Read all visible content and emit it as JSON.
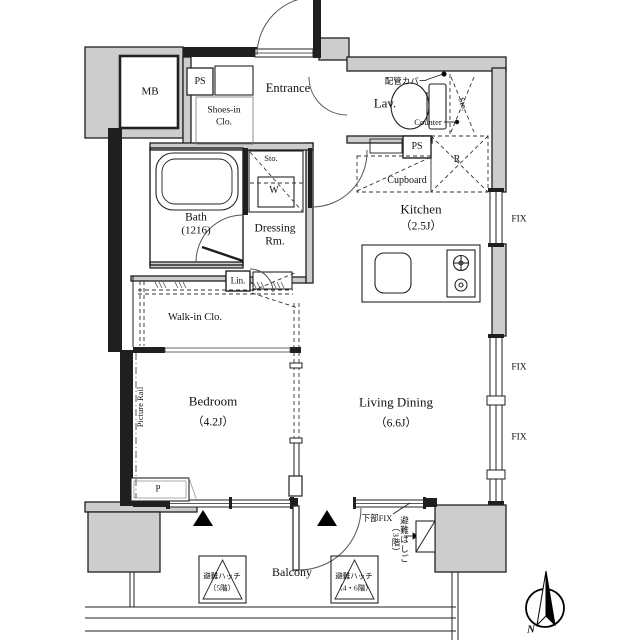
{
  "rooms": {
    "entrance": "Entrance",
    "shoes_line1": "Shoes-in",
    "shoes_line2": "Clo.",
    "lav": "Lav.",
    "kitchen_name": "Kitchen",
    "kitchen_size": "（2.5J）",
    "bath_name": "Bath",
    "bath_size": "(1216)",
    "dressing_line1": "Dressing",
    "dressing_line2": "Rm.",
    "walkin": "Walk-in Clo.",
    "bedroom_name": "Bedroom",
    "bedroom_size": "（4.2J）",
    "living_name": "Living Dining",
    "living_size": "（6.6J）",
    "balcony": "Balcony"
  },
  "labels": {
    "mb": "MB",
    "ps_entrance": "PS",
    "ps_kitchen": "PS",
    "pipe_cover": "配管カバー",
    "sto_lavatory": "Sto.",
    "counter": "Counter",
    "cupboard": "Cupboard",
    "refrigerator": "R",
    "sto_dressing": "Sto.",
    "washer": "W",
    "linen": "Lin.",
    "picture_rail": "Picture Rail",
    "pipe_duct": "P",
    "fix_top": "FIX",
    "fix_middle": "FIX",
    "fix_bottom": "FIX",
    "lower_fix": "下部FIX",
    "hatch_5f_line1": "避難ハッチ",
    "hatch_5f_line2": "（5階）",
    "hatch_46f_line1": "避難ハッチ",
    "hatch_46f_line2": "（4・6階）",
    "ladder_line1": "避難はしご",
    "ladder_line2": "（3階）",
    "north": "N"
  },
  "colors": {
    "wall_black": "#1f1f1f",
    "wall_gray": "#cdcdcd",
    "line": "#222222"
  }
}
